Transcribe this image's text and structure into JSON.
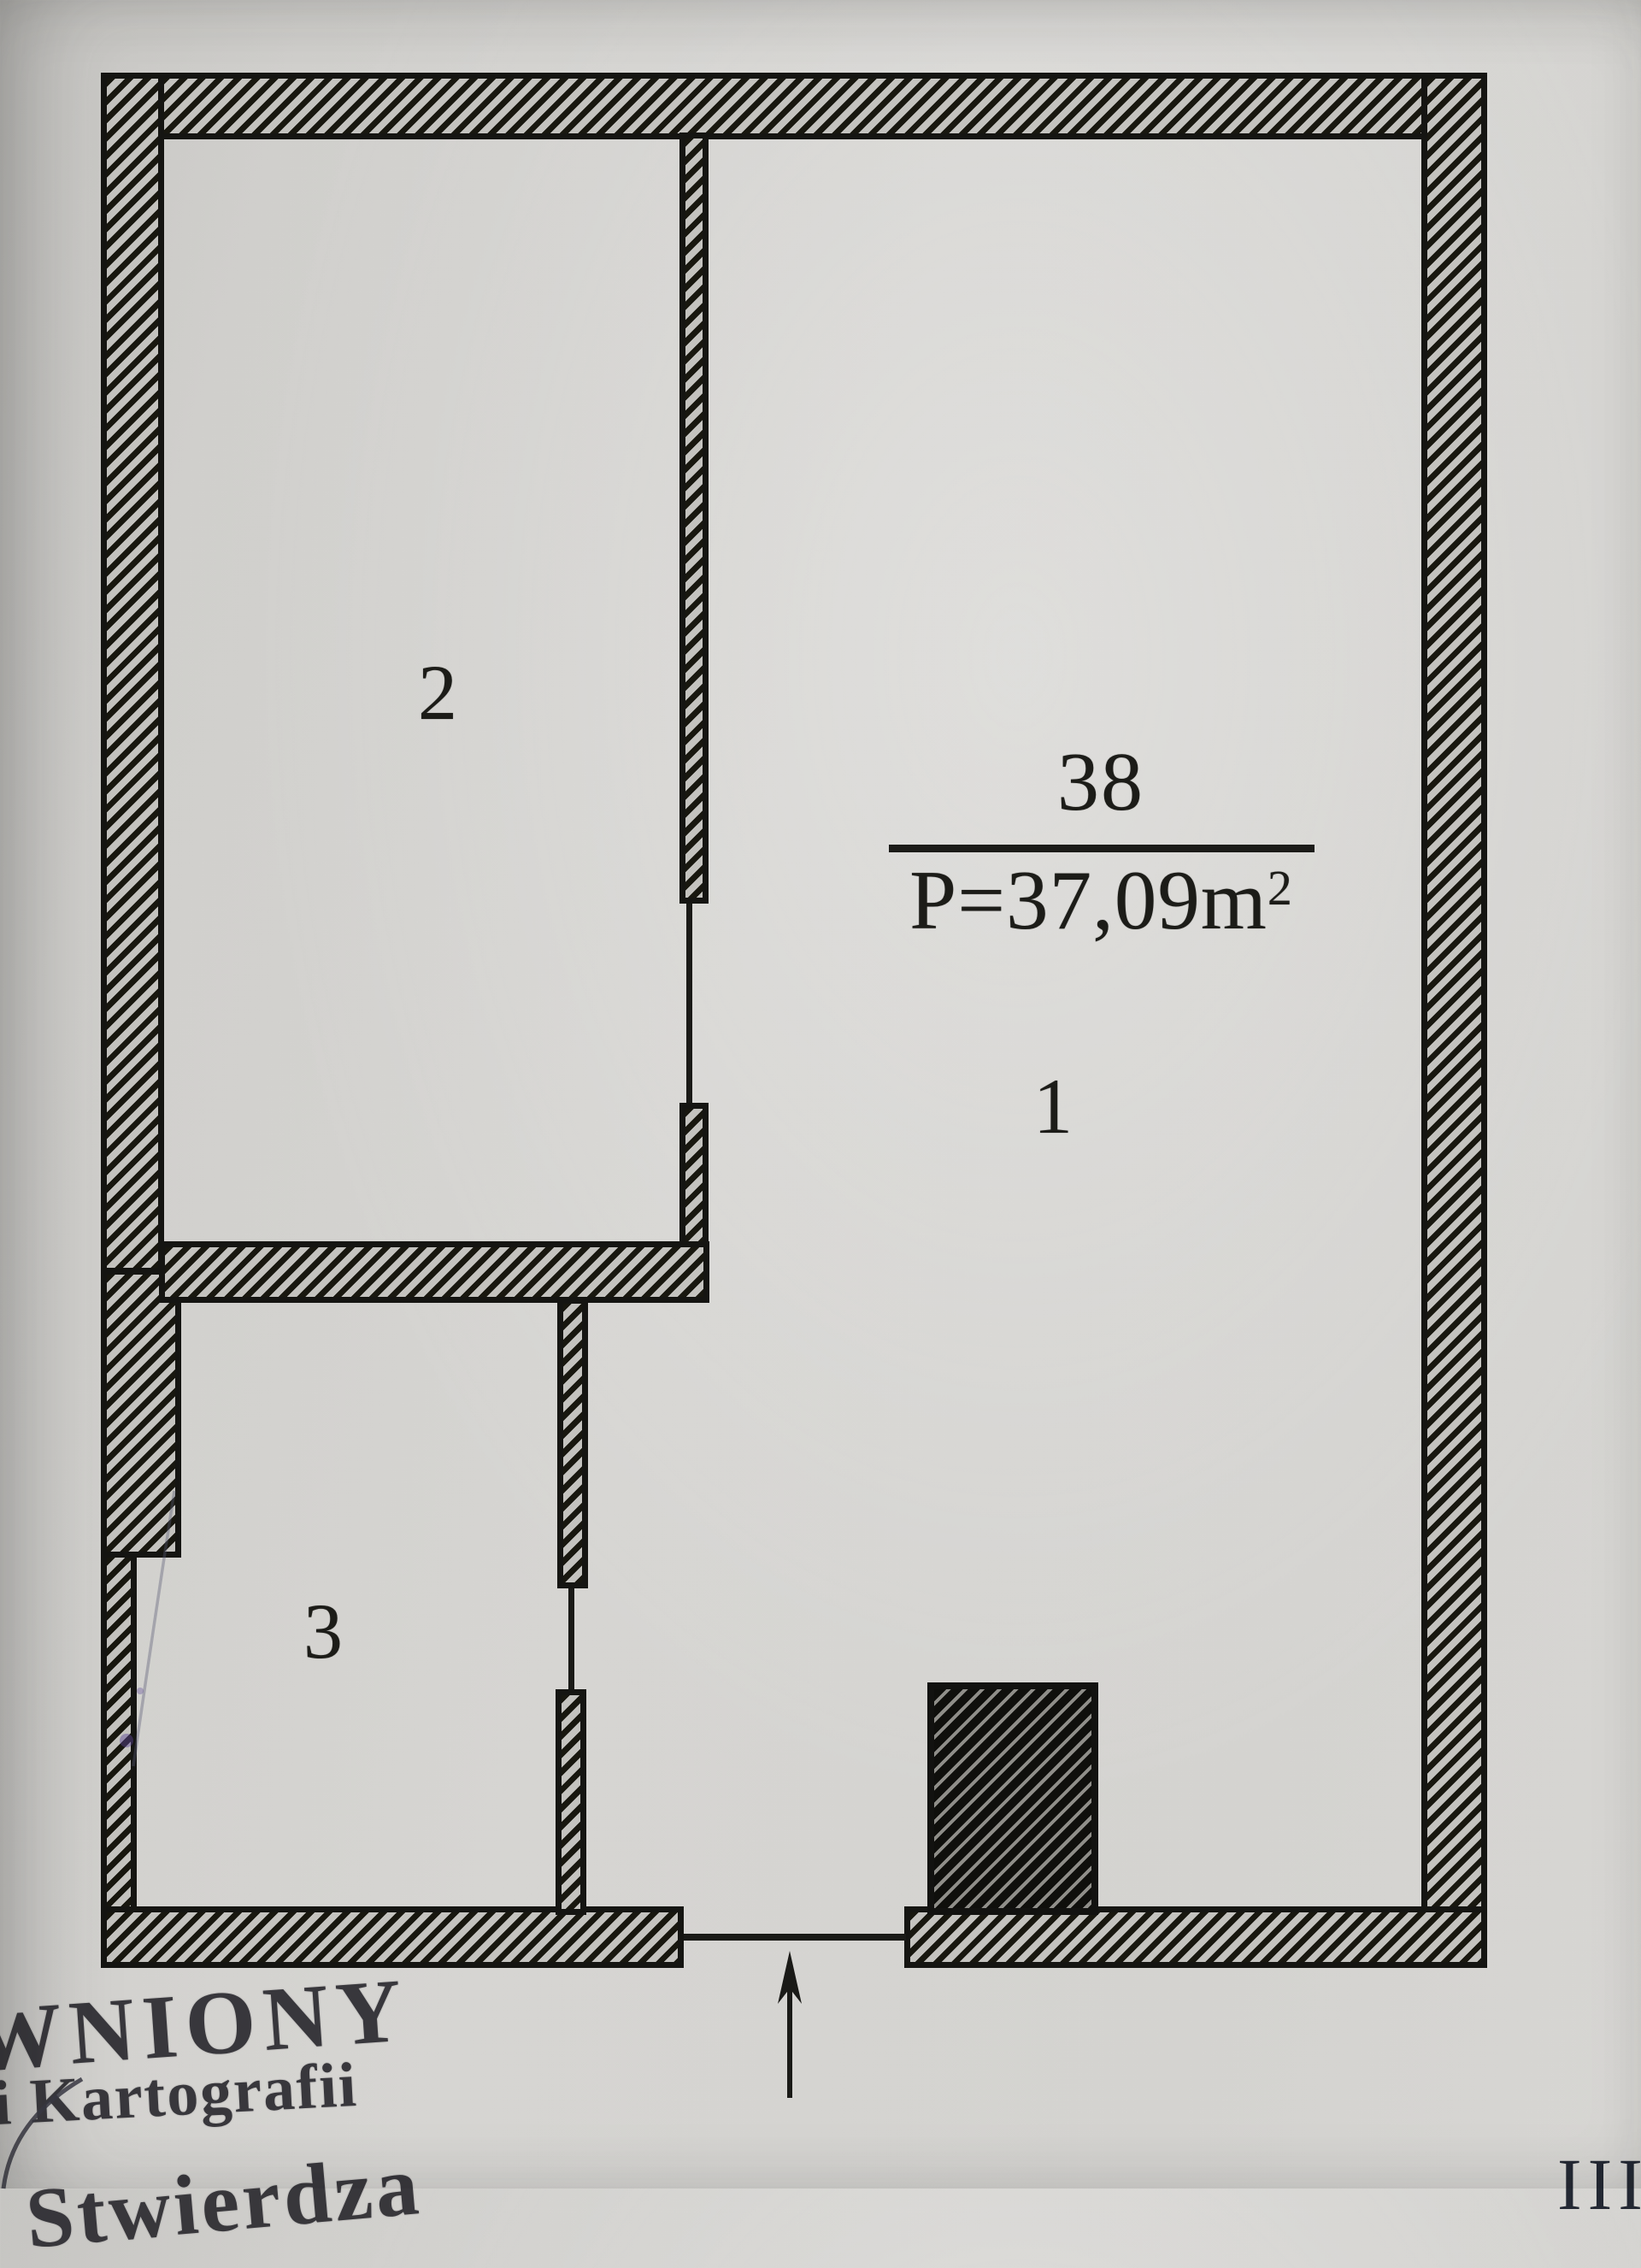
{
  "plan": {
    "unit": {
      "number": "38",
      "area_prefix": "P=37,09m",
      "area_sup": "2"
    },
    "rooms": [
      {
        "label": "1"
      },
      {
        "label": "2"
      },
      {
        "label": "3"
      }
    ]
  },
  "stamp": {
    "line1": "WNIONY",
    "line2": "i Kartografii",
    "line3": "Stwierdza"
  },
  "page": {
    "marker": "III"
  },
  "colors": {
    "paper": "#d4d3d0",
    "ink": "#161613",
    "stamp_ink": "#2d2c31"
  }
}
